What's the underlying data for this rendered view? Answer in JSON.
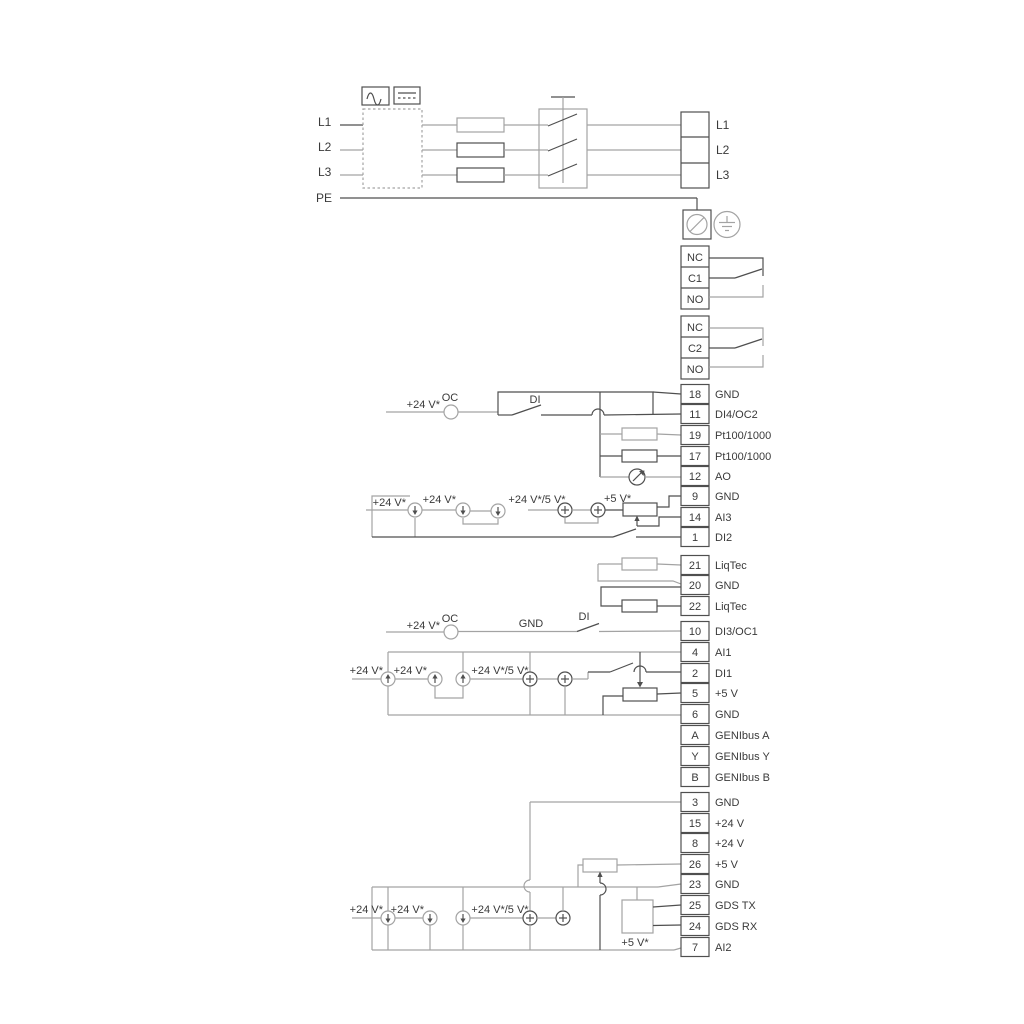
{
  "power": {
    "in": [
      "L1",
      "L2",
      "L3",
      "PE"
    ],
    "out": [
      "L1",
      "L2",
      "L3"
    ]
  },
  "relay1": [
    "NC",
    "C1",
    "NO"
  ],
  "relay2": [
    "NC",
    "C2",
    "NO"
  ],
  "io1": [
    {
      "n": "18",
      "l": "GND"
    },
    {
      "n": "11",
      "l": "DI4/OC2"
    },
    {
      "n": "19",
      "l": "Pt100/1000"
    },
    {
      "n": "17",
      "l": "Pt100/1000"
    },
    {
      "n": "12",
      "l": "AO"
    },
    {
      "n": "9",
      "l": "GND"
    },
    {
      "n": "14",
      "l": "AI3"
    },
    {
      "n": "1",
      "l": "DI2"
    }
  ],
  "liqtec": [
    {
      "n": "21",
      "l": "LiqTec"
    },
    {
      "n": "20",
      "l": "GND"
    },
    {
      "n": "22",
      "l": "LiqTec"
    }
  ],
  "di3": {
    "n": "10",
    "l": "DI3/OC1"
  },
  "io2": [
    {
      "n": "4",
      "l": "AI1"
    },
    {
      "n": "2",
      "l": "DI1"
    },
    {
      "n": "5",
      "l": "+5 V"
    },
    {
      "n": "6",
      "l": "GND"
    },
    {
      "n": "A",
      "l": "GENIbus A"
    },
    {
      "n": "Y",
      "l": "GENIbus Y"
    },
    {
      "n": "B",
      "l": "GENIbus B"
    }
  ],
  "io3": [
    {
      "n": "3",
      "l": "GND"
    },
    {
      "n": "15",
      "l": "+24 V"
    },
    {
      "n": "8",
      "l": "+24 V"
    },
    {
      "n": "26",
      "l": "+5 V"
    },
    {
      "n": "23",
      "l": "GND"
    },
    {
      "n": "25",
      "l": "GDS TX"
    },
    {
      "n": "24",
      "l": "GDS RX"
    },
    {
      "n": "7",
      "l": "AI2"
    }
  ],
  "ann": {
    "s1": {
      "v24": "+24 V*",
      "oc": "OC",
      "di": "DI"
    },
    "s2": {
      "v24a": "+24 V*",
      "v24b": "+24 V*",
      "v245": "+24 V*/5 V*",
      "v5": "+5 V*"
    },
    "s3": {
      "v24": "+24 V*",
      "oc": "OC",
      "gnd": "GND",
      "di": "DI"
    },
    "s4": {
      "v24a": "+24 V*",
      "v24b": "+24 V*",
      "v245": "+24 V*/5 V*"
    },
    "s5": {
      "v24a": "+24 V*",
      "v24b": "+24 V*",
      "v245": "+24 V*/5 V*",
      "v5": "+5 V*"
    }
  },
  "colors": {
    "wire_gray": "#a3a3a3",
    "wire_dark": "#4f4f4f",
    "text": "#3a3a3a",
    "background": "#ffffff"
  }
}
